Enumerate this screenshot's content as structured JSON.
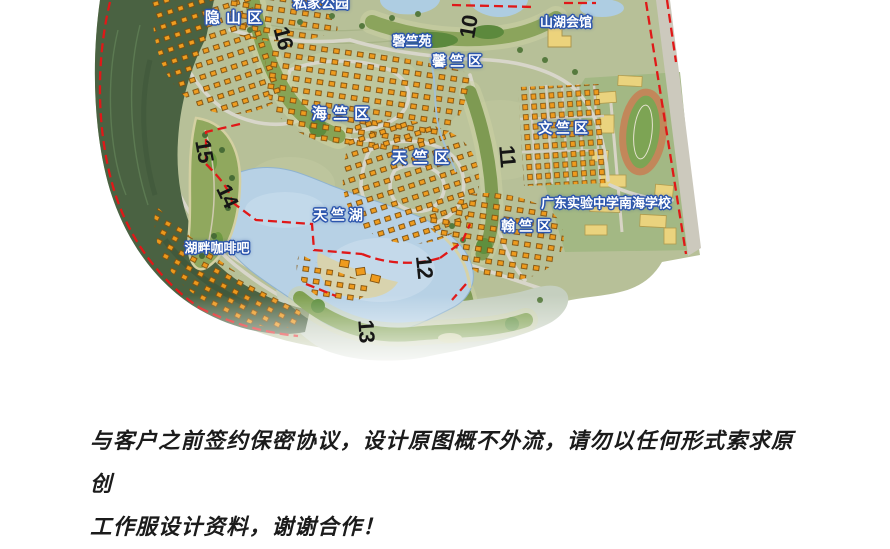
{
  "map": {
    "title": "residential-golf-community-master-plan",
    "labels": [
      {
        "id": "yinshan-district",
        "text": "隐 山 区"
      },
      {
        "id": "private-park",
        "text": "私家公园"
      },
      {
        "id": "shanhu-clubhouse",
        "text": "山湖会馆"
      },
      {
        "id": "qingzhu-garden",
        "text": "磬竺苑"
      },
      {
        "id": "xinzhu-district",
        "text": "馨 竺 区"
      },
      {
        "id": "haizhu-district",
        "text": "海 竺 区"
      },
      {
        "id": "tianzhu-district",
        "text": "天 竺 区"
      },
      {
        "id": "wenzhu-district",
        "text": "文 竺 区"
      },
      {
        "id": "school",
        "text": "广东实验中学南海学校"
      },
      {
        "id": "tianzhu-lake",
        "text": "天 竺 湖"
      },
      {
        "id": "hanzhu-district",
        "text": "翰 竺 区"
      },
      {
        "id": "lakeside-cafe",
        "text": "湖畔咖啡吧"
      }
    ],
    "hole_numbers": [
      "16",
      "10",
      "15",
      "14",
      "11",
      "12",
      "13"
    ],
    "colors": {
      "boundary_red": "#e01818",
      "water_blue": "#b7d1e5",
      "villa_roof_orange": "#ee9b1e",
      "forest_green": "#4a6242",
      "label_outline_blue": "#2b55ad",
      "school_building_yellow": "#ead37e"
    }
  },
  "disclaimer": {
    "line1": "与客户之前签约保密协议，设计原图概不外流，请勿以任何形式索求原创",
    "line2": "工作服设计资料，谢谢合作！"
  }
}
